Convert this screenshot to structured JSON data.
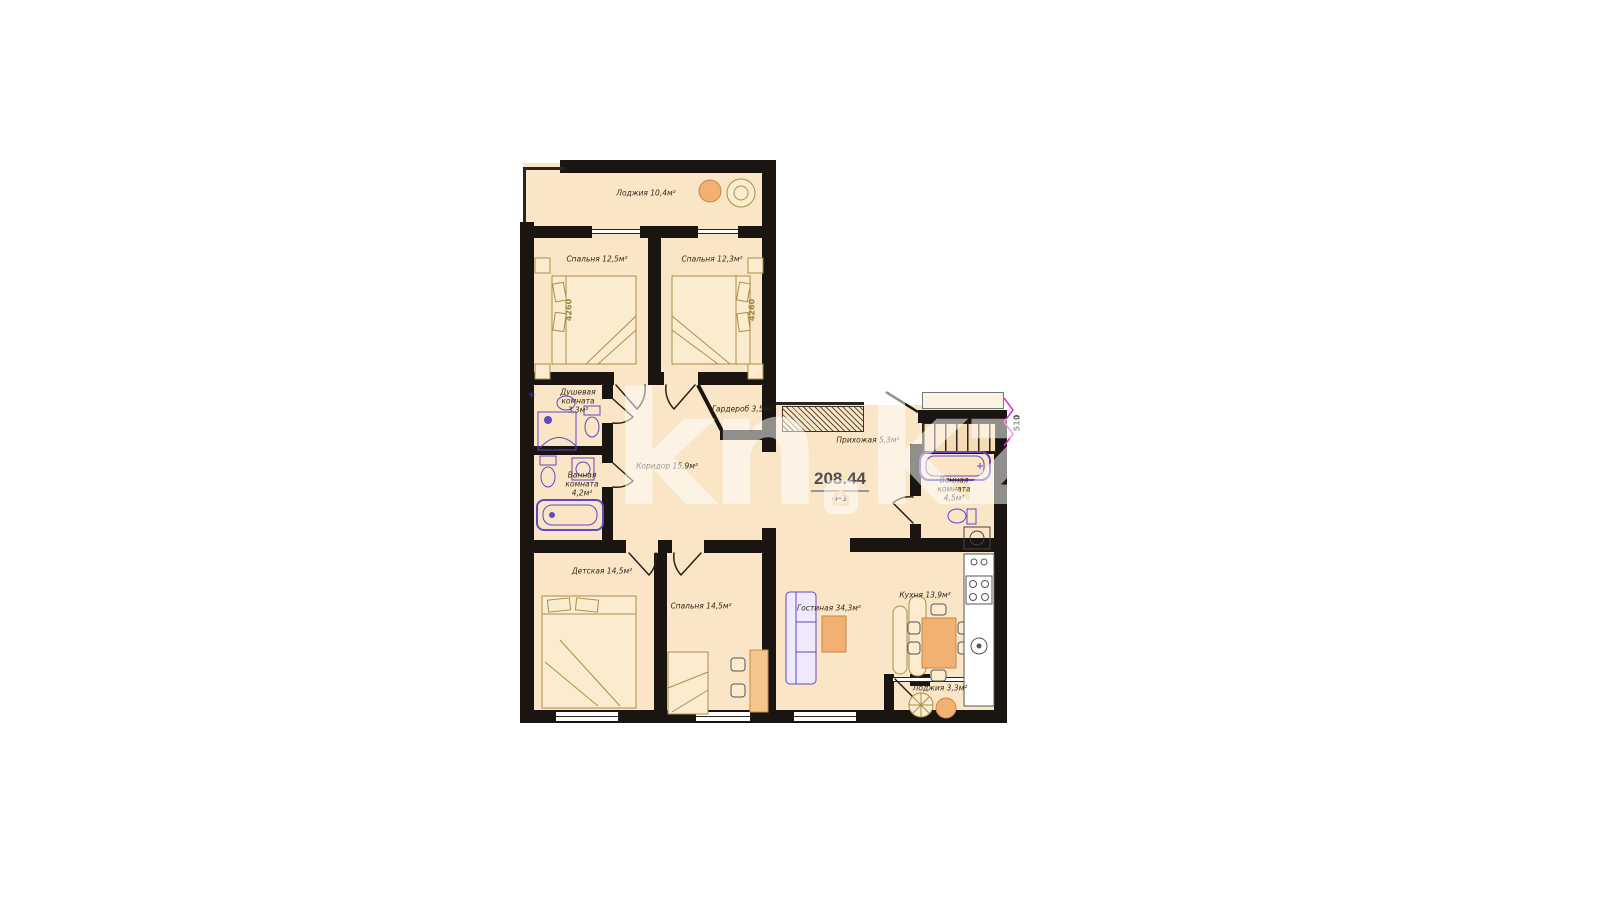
{
  "watermark": {
    "prefix": "kn",
    "suffix": "kz",
    "house_icon": "⌂"
  },
  "plan": {
    "area_value": "208.44",
    "plan_code": "4-1",
    "rooms": {
      "loggia_top": "Лоджия 10,4м²",
      "bedroom_top_left": "Спальня 12,5м²",
      "bedroom_top_right": "Спальня 12,3м²",
      "shower_room": "Душевая комната 3,3м²",
      "wardrobe": "Гардероб 3,5м²",
      "bathroom_left": "Ванная комната 4,2м²",
      "corridor": "Коридор 15,9м²",
      "hallway": "Прихожая 5,3м²",
      "bathroom_right": "Ванная комната 4,5м²",
      "kids_room": "Детская 14,5м²",
      "bedroom_bottom": "Спальня 14,5м²",
      "living_room": "Гостиная 34,3м²",
      "kitchen": "Кухня 13,9м²",
      "loggia_bottom": "Лоджия 3,3м²"
    },
    "dimensions": {
      "bedroom_left_width": "4260",
      "bedroom_right_width": "4260",
      "stairs_width": "510"
    },
    "colors": {
      "floor_fill": "#fae5c6",
      "wall": "#1a1510",
      "plumbing_accent": "#5f49c6",
      "wood_accent": "#a8904a",
      "furniture_orange": "#f2b172",
      "dimension_magenta": "#e32ad6"
    }
  }
}
